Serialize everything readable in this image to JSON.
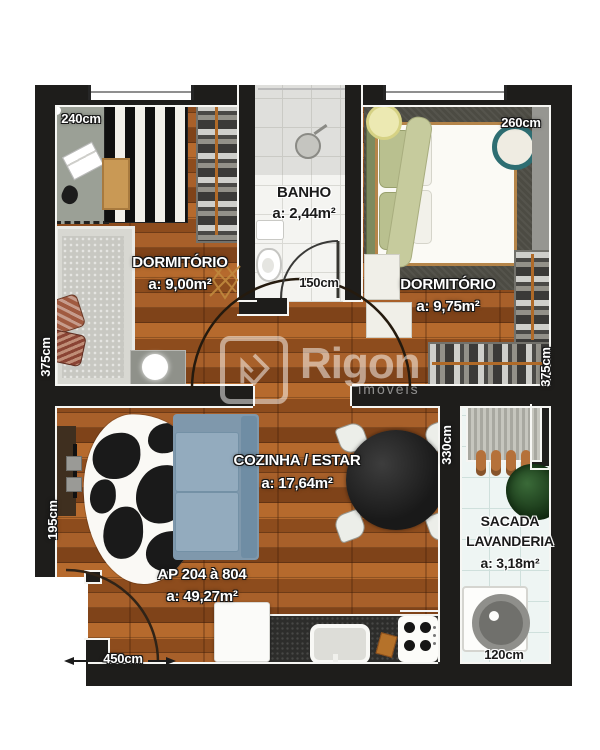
{
  "watermark": {
    "brand": "Rigon",
    "subtitle": "imóveis"
  },
  "rooms": {
    "dorm1": {
      "name": "DORMITÓRIO",
      "area": "a: 9,00m²",
      "top_dim": "240cm",
      "side_dim": "375cm"
    },
    "banho": {
      "name": "BANHO",
      "area": "a: 2,44m²",
      "bottom_dim": "150cm"
    },
    "dorm2": {
      "name": "DORMITÓRIO",
      "area": "a: 9,75m²",
      "top_dim": "260cm",
      "side_dim": "375cm"
    },
    "cozinha": {
      "name": "COZINHA / ESTAR",
      "area": "a: 17,64m²",
      "side_dim": "330cm"
    },
    "sacada": {
      "name_line1": "SACADA",
      "name_line2": "LAVANDERIA",
      "area": "a: 3,18m²",
      "bottom_dim": "120cm"
    },
    "living": {
      "unit": "AP 204 à 804",
      "area": "a: 49,27m²",
      "bottom_dim": "450cm",
      "side_dim": "195cm"
    }
  },
  "colors": {
    "wall": "#1e1d1b",
    "wood": "#a25b24",
    "bath_tile": "#f4f4f1",
    "laundry_tile": "#eef5f3",
    "sofa": "#7f98ac",
    "wardrobe": "#3b3a38",
    "rail_accent": "#b06a28",
    "label_light": "#ffffff"
  }
}
